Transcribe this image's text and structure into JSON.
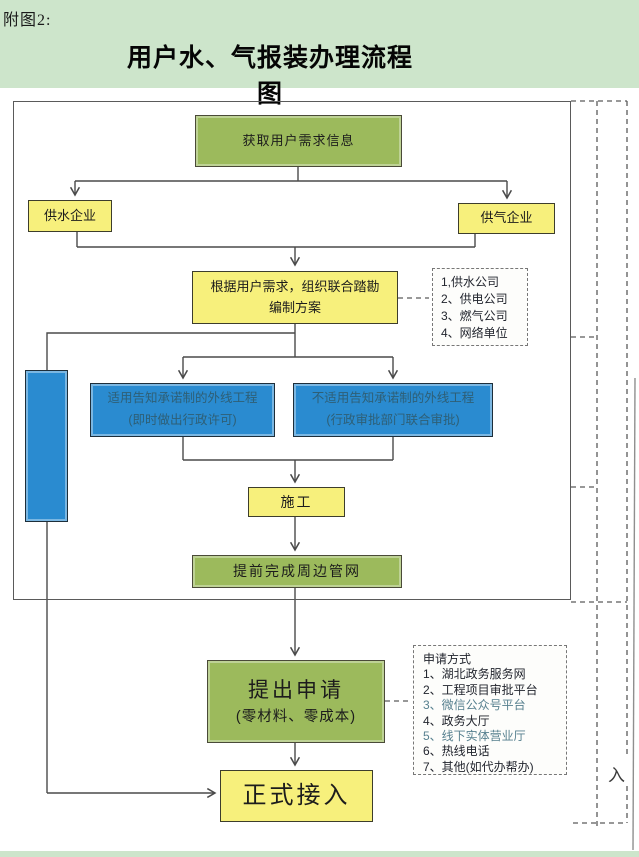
{
  "page": {
    "tag_label": "附图2:",
    "title": "用户水、气报装办理流程图",
    "bottom_margin_label": "入"
  },
  "colors": {
    "page_green": "#cde5cb",
    "box_yellow": "#f7f07c",
    "box_green": "#9cba5c",
    "box_blue": "#2a8bd0",
    "connector_line": "#4a4a4a"
  },
  "nodes": {
    "acquire": {
      "label": "获取用户需求信息"
    },
    "water": {
      "label": "供水企业"
    },
    "gas": {
      "label": "供气企业"
    },
    "survey": {
      "line1": "根据用户需求，组织联合踏勘",
      "line2": "编制方案"
    },
    "promise": {
      "line1": "适用告知承诺制的外线工程",
      "line2": "(即时做出行政许可)"
    },
    "no_promise": {
      "line1": "不适用告知承诺制的外线工程",
      "line2": "(行政审批部门联合审批)"
    },
    "construction": {
      "label": "施工"
    },
    "pipeline": {
      "label": "提前完成周边管网"
    },
    "apply": {
      "line1": "提出申请",
      "line2": "(零材料、零成本)"
    },
    "access": {
      "label": "正式接入"
    }
  },
  "notes": {
    "units": {
      "items": [
        "1,供水公司",
        "2、供电公司",
        "3、燃气公司",
        "4、网络单位"
      ]
    },
    "methods": {
      "title": "申请方式",
      "items": [
        "1、湖北政务服务网",
        "2、工程项目审批平台",
        "3、微信公众号平台",
        "4、政务大厅",
        "5、线下实体营业厅",
        "6、热线电话",
        "7、其他(如代办帮办)"
      ]
    }
  }
}
